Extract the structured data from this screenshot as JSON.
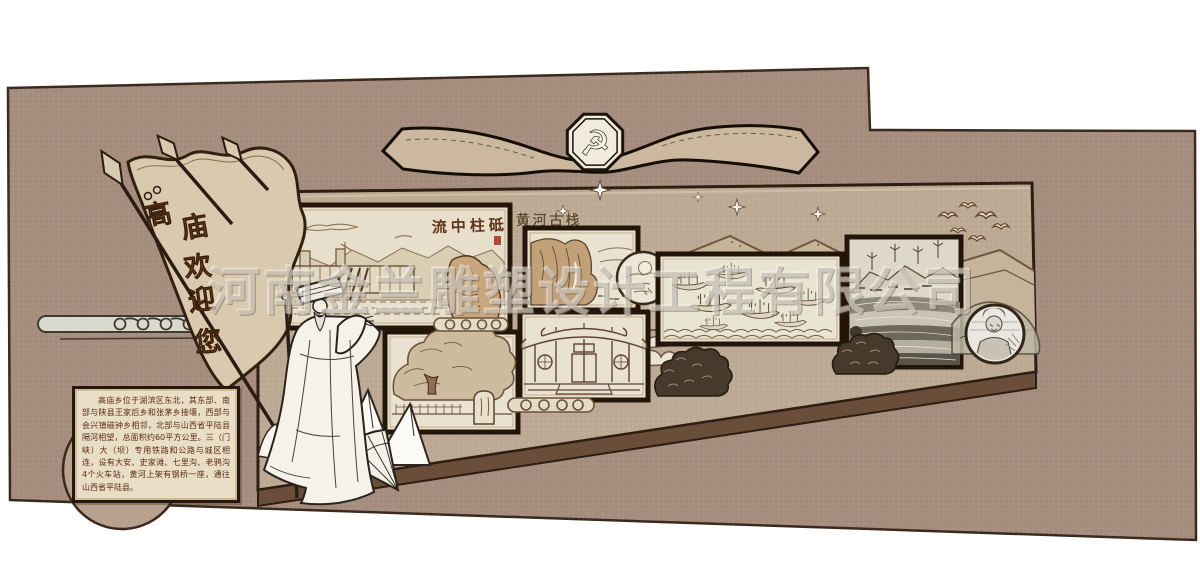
{
  "watermark": {
    "text": "河南金兰雕塑设计工程有限公司"
  },
  "banner": {
    "emblem_symbol": "☭"
  },
  "flag": {
    "text": "高庙欢迎您",
    "chars": [
      "高",
      "庙",
      "欢",
      "迎",
      "您"
    ]
  },
  "panels": {
    "dam": {
      "title": "流中柱砥"
    },
    "cliff": {
      "title": "黄河古栈"
    }
  },
  "info_box": {
    "text": "高庙乡位于湖滨区东北，其东部、南部与陕县王家后乡和张茅乡接壤，西部与会兴镇磁钟乡相邻，北部与山西省平陆县隔河相望，总面积约60平方公里。三（门峡）大（坝）专用铁路和公路与城区相连，设有大安、史家滩、七里沟、老鸦沟4个火车站，黄河上架有钢桥一座，通往山西省平陆县。"
  },
  "colors": {
    "wall": "#a68e7f",
    "board": "#bdaa95",
    "panel_bg": "#eae2d0",
    "frame_dark": "#241509",
    "flag_text": "#7c4a22",
    "seal_red": "#a83a28",
    "info_text": "#5e2a16",
    "ribbon": "#cbb89e",
    "statue_line": "#29231d"
  }
}
